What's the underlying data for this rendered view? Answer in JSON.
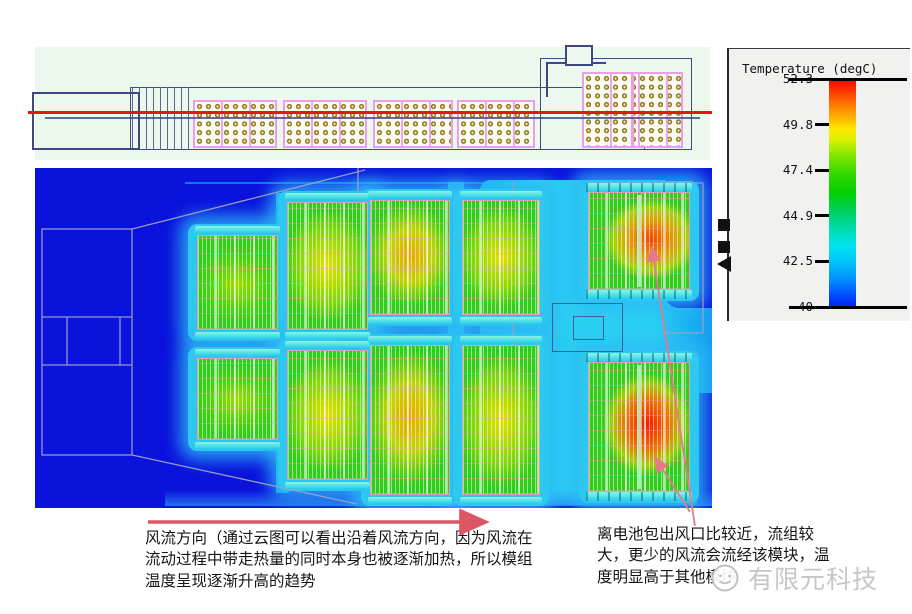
{
  "legend": {
    "title": "Temperature (degC)",
    "ticks": [
      "52.3",
      "49.8",
      "47.4",
      "44.9",
      "42.5",
      "40"
    ]
  },
  "annotations": {
    "flow_note": "风流方向（通过云图可以看出沿着风流方向，因为风流在流动过程中带走热量的同时本身也被逐渐加热，所以模组温度呈现逐渐升高的趋势",
    "outlet_note": "离电池包出风口比较近，流组较大，更少的风流会流经该模块，温度明显高于其他模块"
  },
  "watermark": {
    "text": "有限元科技"
  },
  "colors": {
    "hot_max": "#fb0000",
    "cold_min": "#0020f0",
    "flow_arrow": "#dd5663",
    "pointer_line": "#e8798a",
    "section_line": "#e61616"
  },
  "chart_data": {
    "type": "heatmap",
    "legend_label": "Temperature (degC)",
    "scale_ticks_degC": [
      52.3,
      49.8,
      47.4,
      44.9,
      42.5,
      40
    ],
    "range_degC": [
      40,
      52.3
    ],
    "background_value_degC": 40,
    "flow_region_value_degC": 42.5,
    "modules": [
      {
        "id": "top-1",
        "heat": "green",
        "approx_temp_degC": 46
      },
      {
        "id": "top-2",
        "heat": "yellow",
        "approx_temp_degC": 47.5
      },
      {
        "id": "top-3",
        "heat": "amber",
        "approx_temp_degC": 48.5
      },
      {
        "id": "top-4",
        "heat": "yellow",
        "approx_temp_degC": 47.5
      },
      {
        "id": "top-right",
        "heat": "orange",
        "approx_temp_degC": 50.5
      },
      {
        "id": "bottom-1",
        "heat": "green",
        "approx_temp_degC": 46
      },
      {
        "id": "bottom-2",
        "heat": "yellow",
        "approx_temp_degC": 47.5
      },
      {
        "id": "bottom-3",
        "heat": "amber",
        "approx_temp_degC": 48.5
      },
      {
        "id": "bottom-4",
        "heat": "yellow",
        "approx_temp_degC": 47.5
      },
      {
        "id": "bottom-right",
        "heat": "red",
        "approx_temp_degC": 52
      }
    ]
  }
}
